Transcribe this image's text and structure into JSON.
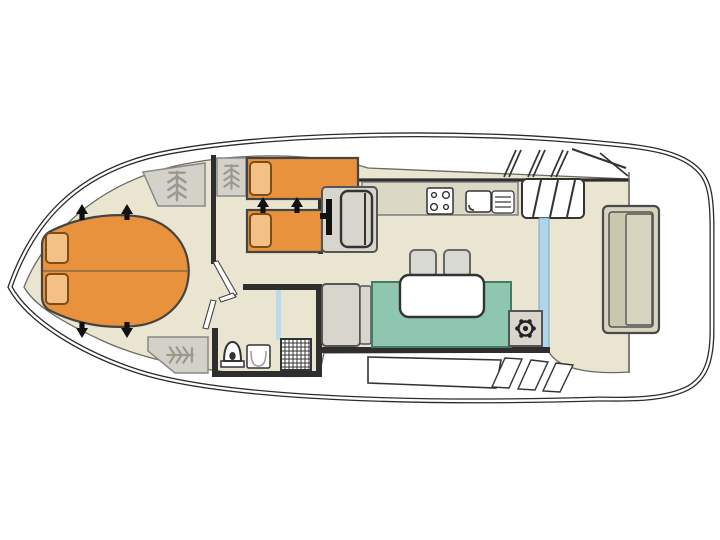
{
  "plan": {
    "type": "boat-floor-plan",
    "orientation": "bow-left",
    "labels": {
      "bow_cabin": "Bow cabin convertible dinette berth",
      "mid_cabin": "Mid cabin twin berths",
      "helm_seat": "Inside helm seat with steering wheel",
      "bathroom": "Bathroom with toilet, washbasin and shower",
      "galley": "Galley with hob and sink",
      "saloon": "Saloon with table, stools and sofa",
      "steering_pod": "Steering position with ship wheel",
      "aft_deck": "Aft deck with bench seat",
      "stairs": "Steps to deck",
      "sliding_door": "Sliding glass door",
      "wardrobe": "Hanging locker",
      "window_band": "Side windows",
      "shower_screen": "Shower screen"
    }
  },
  "palette": {
    "hull-line": "#2b2b2b",
    "floor": "#eae5d1",
    "furn-orange": "#e8923e",
    "pillow-orange": "#f3c187",
    "pillow-border": "#7d4e14",
    "wardrobe-gray": "#d3d1c8",
    "icon-gray": "#9b998f",
    "counter": "#dbd9c6",
    "sofa-teal": "#8fc6b0",
    "chair-gray": "#d9d9d4",
    "unit-gray": "#d8d6cc",
    "bench-tan": "#d6d3bf",
    "bench-tan-dark": "#cac7ae",
    "glass-blue": "#aed6ea",
    "shower-blue": "#b9dcec",
    "wall-dark": "#2e2e2e",
    "line-mid": "#555555",
    "ink": "#333333"
  }
}
